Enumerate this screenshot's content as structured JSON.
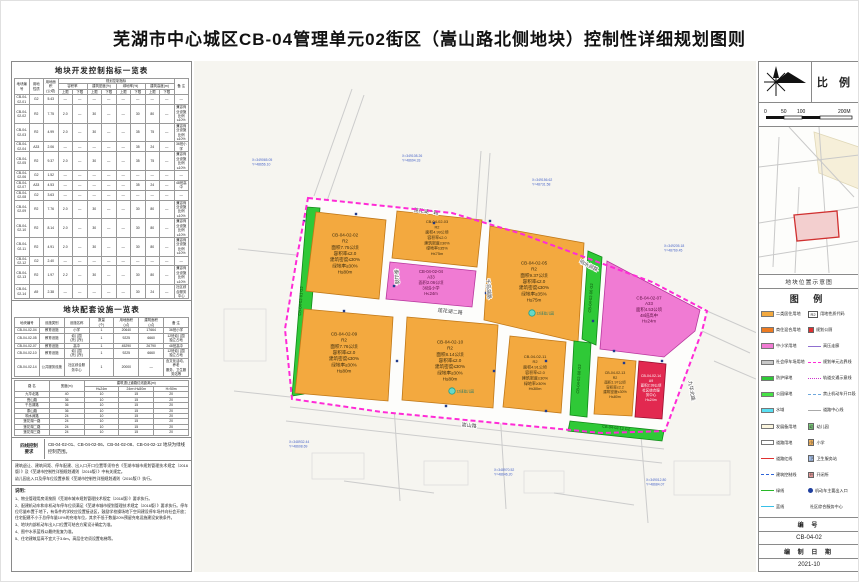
{
  "title": "芜湖市中心城区CB-04管理单元02街区（嵩山路北侧地块）控制性详细规划图则",
  "left_panel": {
    "table1": {
      "title": "地块开发控制指标一览表",
      "header": [
        [
          {
            "t": "地块编号",
            "rs": 3
          },
          {
            "t": "用地\n性质",
            "rs": 3
          },
          {
            "t": "用地面积\n(公顷)",
            "rs": 3
          },
          {
            "t": "规划控制指标",
            "cs": 8
          },
          {
            "t": "备 注",
            "rs": 3
          }
        ],
        [
          {
            "t": "容积率",
            "cs": 2
          },
          {
            "t": "建筑密度(%)",
            "cs": 2
          },
          {
            "t": "绿地率(%)",
            "cs": 2
          },
          {
            "t": "建筑高度(m)",
            "cs": 2
          }
        ],
        [
          {
            "t": "上限"
          },
          {
            "t": "下限"
          },
          {
            "t": "上限"
          },
          {
            "t": "下限"
          },
          {
            "t": "上限"
          },
          {
            "t": "下限"
          },
          {
            "t": "上限"
          },
          {
            "t": "下限"
          }
        ]
      ],
      "rows": [
        [
          "CB-04-02-01",
          "G2",
          "5.43",
          "—",
          "—",
          "—",
          "—",
          "—",
          "—",
          "—",
          "—",
          "—"
        ],
        [
          "CB-04-02-02",
          "R2",
          "7.75",
          "2.0",
          "—",
          "30",
          "—",
          "—",
          "30",
          "80",
          "—",
          "兼容商业设施比例≤10%"
        ],
        [
          "CB-04-02-03",
          "R2",
          "4.99",
          "2.0",
          "—",
          "30",
          "—",
          "—",
          "35",
          "75",
          "—",
          "兼容商业设施比例≤10%"
        ],
        [
          "CB-04-02-04",
          "A33",
          "2.06",
          "—",
          "—",
          "—",
          "—",
          "—",
          "35",
          "24",
          "—",
          "36班小学"
        ],
        [
          "CB-04-02-05",
          "R2",
          "9.37",
          "2.0",
          "—",
          "30",
          "—",
          "—",
          "35",
          "75",
          "—",
          "兼容商业设施比例≤10%"
        ],
        [
          "CB-04-02-06",
          "G2",
          "1.52",
          "—",
          "—",
          "—",
          "—",
          "—",
          "—",
          "—",
          "—",
          "—"
        ],
        [
          "CB-04-02-07",
          "A33",
          "4.53",
          "—",
          "—",
          "—",
          "—",
          "—",
          "35",
          "24",
          "—",
          "48班高中"
        ],
        [
          "CB-04-02-08",
          "G2",
          "3.63",
          "—",
          "—",
          "—",
          "—",
          "—",
          "—",
          "—",
          "—",
          "—"
        ],
        [
          "CB-04-02-09",
          "R2",
          "7.76",
          "2.0",
          "—",
          "30",
          "—",
          "—",
          "30",
          "80",
          "—",
          "兼容商业设施比例≤10%"
        ],
        [
          "CB-04-02-10",
          "R2",
          "8.14",
          "2.0",
          "—",
          "30",
          "—",
          "—",
          "30",
          "80",
          "—",
          "兼容商业设施比例≤10%"
        ],
        [
          "CB-04-02-11",
          "R2",
          "4.91",
          "2.0",
          "—",
          "30",
          "—",
          "—",
          "30",
          "80",
          "—",
          "兼容商业设施比例≤10%"
        ],
        [
          "CB-04-02-12",
          "G2",
          "2.40",
          "—",
          "—",
          "—",
          "—",
          "—",
          "—",
          "—",
          "—",
          "—"
        ],
        [
          "CB-04-02-13",
          "R2",
          "1.97",
          "2.2",
          "—",
          "30",
          "—",
          "—",
          "30",
          "80",
          "—",
          "兼容商业设施比例≤10%"
        ],
        [
          "CB-04-02-14",
          "A9",
          "2.38",
          "—",
          "—",
          "—",
          "—",
          "—",
          "30",
          "24",
          "—",
          "社区综合服务中心"
        ]
      ]
    },
    "table2": {
      "title": "地块配套设施一览表",
      "header": [
        [
          {
            "t": "地块编号"
          },
          {
            "t": "设施类别"
          },
          {
            "t": "设施名称"
          },
          {
            "t": "数量\n(个)"
          },
          {
            "t": "用地面积\n(㎡)"
          },
          {
            "t": "建筑面积\n(㎡)"
          },
          {
            "t": "备 注"
          }
        ]
      ],
      "rows": [
        [
          "CB-04-02-04",
          "教育设施",
          "小学",
          "1",
          "20640",
          "17664",
          "36班小学"
        ],
        [
          "CB-04-02-05",
          "教育设施",
          "幼儿园\n(托儿所)",
          "1",
          "9225",
          "6660",
          "12班幼儿园\n独立占地"
        ],
        [
          "CB-04-02-07",
          "教育设施",
          "高中",
          "1",
          "45290",
          "26790",
          "48班高中"
        ],
        [
          "CB-04-02-10",
          "教育设施",
          "幼儿园\n(托儿所)",
          "1",
          "9225",
          "6660",
          "12班幼儿园\n独立占地"
        ],
        [
          "CB-04-02-14",
          "公共服务设施",
          "社区综合服\n务中心",
          "1",
          "20000",
          "—",
          "含文化活动、养老\n服务、卫生服务站等"
        ]
      ]
    },
    "road_table": {
      "header": [
        [
          {
            "t": "路 名",
            "rs": 2
          },
          {
            "t": "宽度(m)",
            "rs": 2
          },
          {
            "t": "建筑退让道路红线距离(m)",
            "cs": 3
          }
        ],
        [
          {
            "t": "H≤24m"
          },
          {
            "t": "24m<H≤50m"
          },
          {
            "t": "H>50m"
          }
        ]
      ],
      "rows": [
        [
          "九华北路",
          "40",
          "10",
          "15",
          "20"
        ],
        [
          "嵩山路",
          "36",
          "10",
          "15",
          "20"
        ],
        [
          "千岛湖路",
          "36",
          "10",
          "15",
          "20"
        ],
        [
          "泰山路",
          "36",
          "10",
          "15",
          "20"
        ],
        [
          "响水涧路",
          "24",
          "10",
          "15",
          "20"
        ],
        [
          "莲花湖一路",
          "24",
          "10",
          "15",
          "20"
        ],
        [
          "莲花湖二路",
          "24",
          "10",
          "15",
          "20"
        ],
        [
          "莲花湖三路",
          "24",
          "10",
          "15",
          "20"
        ]
      ]
    },
    "four_lines": {
      "label": "四线控制\n要求",
      "text": "CB-04-02-01、CB-04-02-06、CB-04-02-08、CB-04-02-12 地块为绿线控制范围。"
    },
    "noteA": [
      "建筑退让、建筑间距、停车配建、出入口开口位置等须符合《芜湖市城市规划管理技术规定（2016版）》及《芜湖市控制性详细规划通则（2016版）》中有关规定。",
      "幼儿园出入口及停车位设置参照《芜湖市控制性详细规划通则（2016版）》执行。"
    ],
    "notes": {
      "title": "说明：",
      "items": [
        "1、物业管理用房须按照《芜湖市城市规划管理技术规定（2016版）》要求执行。",
        "2、配建机动车和非机动车停车位须满足《芜湖市城市规划管理技术规定（2016版）》要求执行。停车位尽量布置于地下，有条件的学校应设置接送区，鼓励学校操场地下空间建设停车场并向社会开放；住宅配建不小于总停车量10%的充电车位，其余不低于数量20%预留充电设施建设安装条件。",
        "3、地块内部机动车出入口位置可结合方案设计确定为准。",
        "4、图中水系蓝线以最终批复为准。",
        "5、住宅建筑层高不宜大于3.6m，高层住宅须设置电梯等。"
      ]
    }
  },
  "right_panel": {
    "compass_label": "比 例",
    "scale_ticks": [
      "0",
      "50",
      "100",
      "200M"
    ],
    "location_caption": "地块位置示意图",
    "legend_title": "图 例",
    "legend_items": [
      {
        "k": "fill",
        "c": "#F3A93F",
        "t": "二类居住用地"
      },
      {
        "k": "fill",
        "c": "#ED7B22",
        "t": "商住混合用地"
      },
      {
        "k": "fill",
        "c": "#F07BD3",
        "t": "中小学用地"
      },
      {
        "k": "fill",
        "c": "#C8C8C8",
        "t": "社会停车场用地"
      },
      {
        "k": "fill",
        "c": "#2FC937",
        "t": "防护绿地"
      },
      {
        "k": "fill",
        "c": "#46E346",
        "t": "公园绿地"
      },
      {
        "k": "fill",
        "c": "#58DFF2",
        "t": "水域"
      },
      {
        "k": "fill",
        "c": "#FBF5DE",
        "t": "发展备用地"
      },
      {
        "k": "outline",
        "c": "#FFFFFF",
        "t": "道路用地"
      },
      {
        "k": "line",
        "c": "#E03030",
        "t": "道路红线"
      },
      {
        "k": "dash",
        "c": "#2E64D8",
        "t": "建筑控制线"
      },
      {
        "k": "line",
        "c": "#28B828",
        "t": "绿线"
      },
      {
        "k": "line",
        "c": "#38C0E8",
        "t": "蓝线"
      },
      {
        "k": "code",
        "g": "R2",
        "t": "用地性质代码"
      },
      {
        "k": "sq",
        "c": "#E03030",
        "t": "规划公厕"
      },
      {
        "k": "line",
        "c": "#8F6FD0",
        "t": "高压走廊"
      },
      {
        "k": "dash",
        "c": "#FF2BD6",
        "t": "规划单元边界线"
      },
      {
        "k": "dots",
        "c": "#CC33CC",
        "t": "轨道交通示意线"
      },
      {
        "k": "dash",
        "c": "#6FA8DC",
        "t": "禁止机动车开口段"
      },
      {
        "k": "line",
        "c": "#AAAAAA",
        "t": "道路中心线"
      },
      {
        "k": "icon",
        "c": "#7FD87F",
        "g": "幼",
        "t": "幼儿园"
      },
      {
        "k": "icon",
        "c": "#F2B25C",
        "g": "小",
        "t": "小学"
      },
      {
        "k": "icon",
        "c": "#A8C4F0",
        "g": "卫",
        "t": "卫生服务站"
      },
      {
        "k": "icon",
        "c": "#F0A0A0",
        "g": "开",
        "t": "开闭所"
      },
      {
        "k": "dot",
        "c": "#1F3F9F",
        "t": "机动车主要出入口"
      },
      {
        "k": "box",
        "c": "#E22950",
        "t": "社区综合服务中心"
      }
    ],
    "number_label": "编 号",
    "number_value": "CB-04-02",
    "date_label": "编 制 日 期",
    "date_value": "2021-10"
  },
  "map": {
    "boundary": "114,137 258,152 328,173 458,221 513,250 508,270 471,370 408,372 188,351 98,338 91,268 103,196",
    "boundary_color": "#FF2BD6",
    "context_lines": [
      "120,135 158,28",
      "133,140 170,34",
      "287,90 282,160",
      "296,92 291,162",
      "513,250 563,272",
      "508,270 556,292",
      "200,345 206,440",
      "306,350 312,448",
      "446,362 454,462",
      "96,346 470,388",
      "92,360 468,402",
      "40,330 96,336",
      "44,188 102,194",
      "150,420 240,432",
      "360,432 440,444",
      "520,300 562,318"
    ],
    "context_boxes": [
      {
        "x": 118,
        "y": 392,
        "w": 52,
        "h": 26
      },
      {
        "x": 230,
        "y": 400,
        "w": 44,
        "h": 24
      },
      {
        "x": 330,
        "y": 410,
        "w": 40,
        "h": 22
      },
      {
        "x": 30,
        "y": 248,
        "w": 42,
        "h": 52
      },
      {
        "x": 480,
        "y": 400,
        "w": 56,
        "h": 34
      }
    ],
    "parcels": [
      {
        "pts": "113,146 126,147 110,333 98,335",
        "fill": "#2FC937",
        "stroke": "#118A18",
        "label": {
          "cx": 108,
          "cy": 240,
          "fs": 4.0,
          "lh": 5,
          "rot": -86,
          "color": "#0B4D0B",
          "lines": [
            "CB-04-02-01  G2"
          ]
        }
      },
      {
        "pts": "122,151 192,159 185,238 112,230",
        "fill": "#F3A93F",
        "stroke": "#C07818",
        "label": {
          "cx": 151,
          "cy": 194,
          "fs": 4.6,
          "lh": 6.2,
          "color": "#3D2E10",
          "lines": [
            "CB-04-02-02",
            "R2",
            "面积7.75公顷",
            "容积率≤2.0",
            "建筑密度≤30%",
            "绿地率≥30%",
            "H≤80m"
          ]
        }
      },
      {
        "pts": "203,150 288,159 283,206 198,197",
        "fill": "#F3A93F",
        "stroke": "#C07818",
        "label": {
          "cx": 243,
          "cy": 178,
          "fs": 3.9,
          "lh": 5.3,
          "color": "#3D2E10",
          "lines": [
            "CB-04-02-03",
            "R2",
            "面积4.99公顷",
            "容积率≤2.0",
            "建筑密度≤30%",
            "绿地率≥35%",
            "H≤75m"
          ]
        }
      },
      {
        "pts": "196,201 282,210 278,246 192,238",
        "fill": "#F07BD3",
        "stroke": "#B8389E",
        "label": {
          "cx": 237,
          "cy": 223,
          "fs": 4.2,
          "lh": 5.6,
          "color": "#5C1040",
          "lines": [
            "CB-04-02-04",
            "A33",
            "面积2.06公顷",
            "36班小学",
            "H≤24m"
          ]
        }
      },
      {
        "pts": "296,165 390,182 384,281 290,259",
        "fill": "#F3A93F",
        "stroke": "#C07818",
        "label": {
          "cx": 340,
          "cy": 222,
          "fs": 4.6,
          "lh": 6.2,
          "color": "#3D2E10",
          "lines": [
            "CB-04-02-05",
            "R2",
            "面积9.37公顷",
            "容积率≤2.0",
            "建筑密度≤30%",
            "绿地率≥35%",
            "H≤75m"
          ]
        }
      },
      {
        "pts": "394,190 408,196 402,284 388,278",
        "fill": "#2FC937",
        "stroke": "#118A18",
        "label": {
          "cx": 398,
          "cy": 237,
          "fs": 4.0,
          "lh": 5,
          "rot": -86,
          "color": "#0B4D0B",
          "lines": [
            "CB-04-02-06  G2"
          ]
        }
      },
      {
        "pts": "413,200 506,249 501,270 470,296 406,288",
        "fill": "#F07BD3",
        "stroke": "#B8389E",
        "label": {
          "cx": 455,
          "cy": 250,
          "fs": 4.4,
          "lh": 5.8,
          "color": "#5C1040",
          "lines": [
            "CB-04-02-07",
            "A33",
            "面积4.53公顷",
            "48班高中",
            "H≤24m"
          ]
        }
      },
      {
        "pts": "110,248 199,256 194,340 101,332",
        "fill": "#F3A93F",
        "stroke": "#C07818",
        "label": {
          "cx": 150,
          "cy": 293,
          "fs": 4.6,
          "lh": 6.2,
          "color": "#3D2E10",
          "lines": [
            "CB-04-02-09",
            "R2",
            "面积7.76公顷",
            "容积率≤2.0",
            "建筑密度≤30%",
            "绿地率≥30%",
            "H≤80m"
          ]
        }
      },
      {
        "pts": "213,256 304,264 299,347 208,339",
        "fill": "#F3A93F",
        "stroke": "#C07818",
        "label": {
          "cx": 256,
          "cy": 301,
          "fs": 4.6,
          "lh": 6.2,
          "color": "#3D2E10",
          "lines": [
            "CB-04-02-10",
            "R2",
            "面积8.14公顷",
            "容积率≤2.0",
            "建筑密度≤30%",
            "绿地率≥30%",
            "H≤80m"
          ]
        }
      },
      {
        "pts": "316,275 372,281 367,352 309,346",
        "fill": "#F3A93F",
        "stroke": "#C07818",
        "label": {
          "cx": 341,
          "cy": 313,
          "fs": 4.0,
          "lh": 5.4,
          "color": "#3D2E10",
          "lines": [
            "CB-04-02-11",
            "R2",
            "面积4.91公顷",
            "容积率≤2.0",
            "建筑密度≤30%",
            "绿地率≥30%",
            "H≤80m"
          ]
        }
      },
      {
        "pts": "380,280 397,282 393,356 376,354",
        "fill": "#2FC937",
        "stroke": "#118A18",
        "label": {
          "cx": 386,
          "cy": 318,
          "fs": 4.0,
          "lh": 5,
          "rot": -86,
          "color": "#0B4D0B",
          "lines": [
            "CB-04-02-08  G2"
          ]
        }
      },
      {
        "pts": "404,296 442,300 438,355 400,353",
        "fill": "#F3A93F",
        "stroke": "#C07818",
        "label": {
          "cx": 421,
          "cy": 325,
          "fs": 3.6,
          "lh": 4.8,
          "color": "#3D2E10",
          "lines": [
            "CB-04-02-13",
            "R2",
            "面积1.97公顷",
            "容积率≤2.2",
            "建筑密度≤30%",
            "H≤80m"
          ]
        }
      },
      {
        "pts": "445,300 472,303 468,358 441,356",
        "fill": "#E22950",
        "stroke": "#990F2E",
        "label": {
          "cx": 457,
          "cy": 328,
          "fs": 3.5,
          "lh": 4.8,
          "color": "#FFFFFF",
          "lines": [
            "CB-04-02-14",
            "A9",
            "面积2.38公顷",
            "社区综合服",
            "务中心",
            "H≤24m"
          ]
        }
      },
      {
        "pts": "376,360 470,370 468,380 374,370",
        "fill": "#2FC937",
        "stroke": "#118A18",
        "label": {
          "cx": 422,
          "cy": 368,
          "fs": 3.8,
          "lh": 5,
          "rot": 6,
          "color": "#0B4D0B",
          "lines": [
            "CB-04-02-12  G2"
          ]
        }
      }
    ],
    "ticks": [
      [
        162,
        153
      ],
      [
        240,
        162
      ],
      [
        200,
        225
      ],
      [
        292,
        232
      ],
      [
        296,
        160
      ],
      [
        203,
        300
      ],
      [
        300,
        310
      ],
      [
        352,
        300
      ],
      [
        399,
        260
      ],
      [
        420,
        290
      ],
      [
        252,
        345
      ],
      [
        352,
        350
      ],
      [
        150,
        250
      ],
      [
        110,
        160
      ],
      [
        430,
        302
      ],
      [
        468,
        300
      ]
    ],
    "markers": [
      {
        "x": 338,
        "y": 252,
        "t": "12班幼儿园"
      },
      {
        "x": 258,
        "y": 330,
        "t": "12班幼儿园"
      }
    ],
    "coord_labels": [
      {
        "x": 58,
        "y": 100,
        "a": "X=349065.05",
        "b": "Y=48656.10"
      },
      {
        "x": 208,
        "y": 96,
        "a": "X=349108.26",
        "b": "Y=48694.33"
      },
      {
        "x": 338,
        "y": 120,
        "a": "X=349156.62",
        "b": "Y=48731.58"
      },
      {
        "x": 470,
        "y": 186,
        "a": "X=349205.18",
        "b": "Y=48769.45"
      },
      {
        "x": 95,
        "y": 382,
        "a": "X=348932.44",
        "b": "Y=48608.69"
      },
      {
        "x": 300,
        "y": 410,
        "a": "X=348970.52",
        "b": "Y=48646.20"
      },
      {
        "x": 452,
        "y": 420,
        "a": "X=349012.80",
        "b": "Y=48684.07"
      }
    ],
    "road_labels": [
      {
        "x": 275,
        "y": 366,
        "t": "嵩山路",
        "rot": 6
      },
      {
        "x": 201,
        "y": 216,
        "t": "泰山路",
        "rot": 85
      },
      {
        "x": 293,
        "y": 228,
        "t": "千岛湖路",
        "rot": 85
      },
      {
        "x": 232,
        "y": 152,
        "t": "莲花湖一路",
        "rot": 7
      },
      {
        "x": 256,
        "y": 252,
        "t": "莲花湖二路",
        "rot": 6
      },
      {
        "x": 394,
        "y": 206,
        "t": "响水涧路",
        "rot": 27
      },
      {
        "x": 496,
        "y": 330,
        "t": "九华北路",
        "rot": 80
      }
    ]
  }
}
